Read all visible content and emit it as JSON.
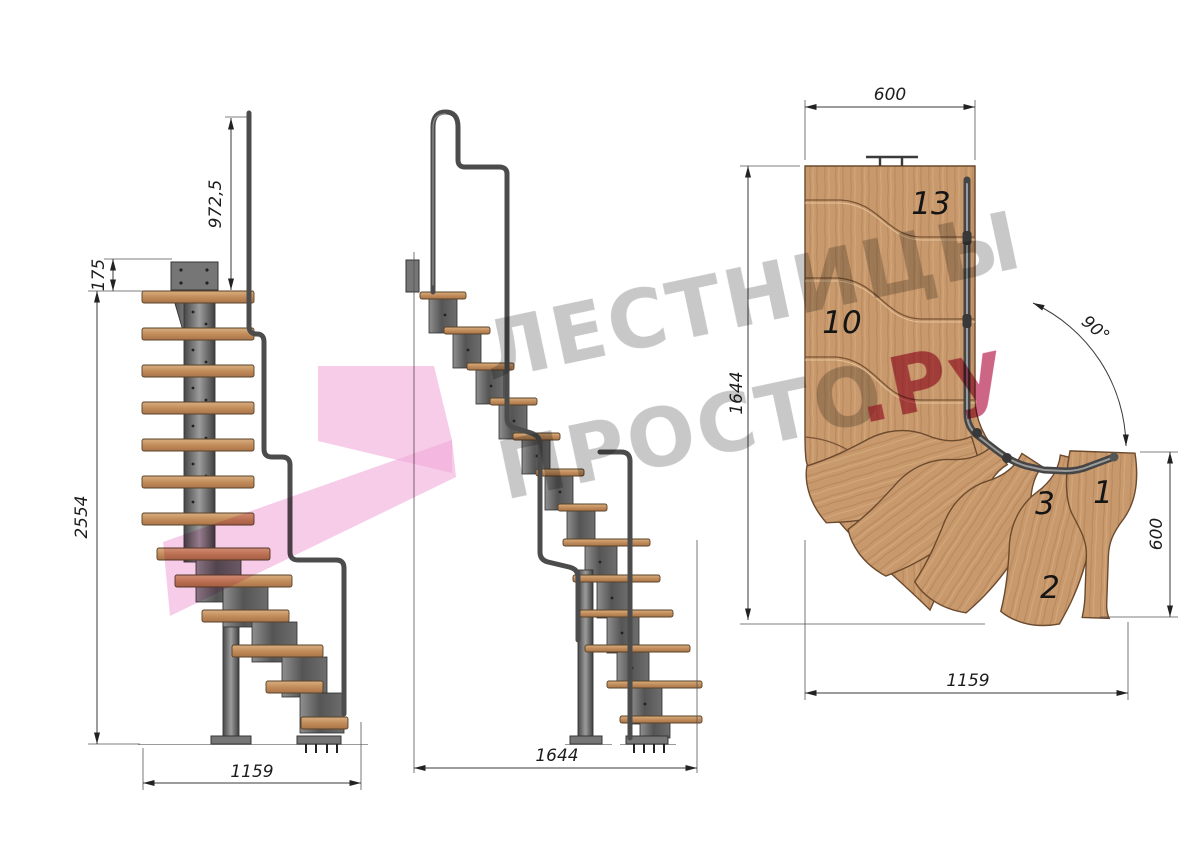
{
  "front_view": {
    "dim_rail_height": "972,5",
    "dim_plate_height": "175",
    "dim_total_height": "2554",
    "dim_width": "1159"
  },
  "side_view": {
    "dim_length": "1644"
  },
  "plan_view": {
    "dim_platform_width": "600",
    "dim_length": "1644",
    "dim_turn_angle": "90°",
    "dim_bottom_run": "600",
    "dim_width": "1159",
    "step_labels": {
      "step13": "13",
      "step10": "10",
      "step3": "3",
      "step1": "1",
      "step2": "2"
    }
  },
  "watermark": {
    "line1": "ЛЕСТНИЦЫ",
    "line2": "ПРОСТО",
    "suffix": ".Ру"
  },
  "colors": {
    "wood": "#c8996c",
    "wood_edge": "#6b4a2e",
    "steel": "#5a5a5a",
    "steel_dark": "#333333",
    "dim_line": "#3a3a3a",
    "watermark_text": "#9a9a9a",
    "watermark_pink": "#f2aadb",
    "watermark_accent": "#c13e66"
  }
}
